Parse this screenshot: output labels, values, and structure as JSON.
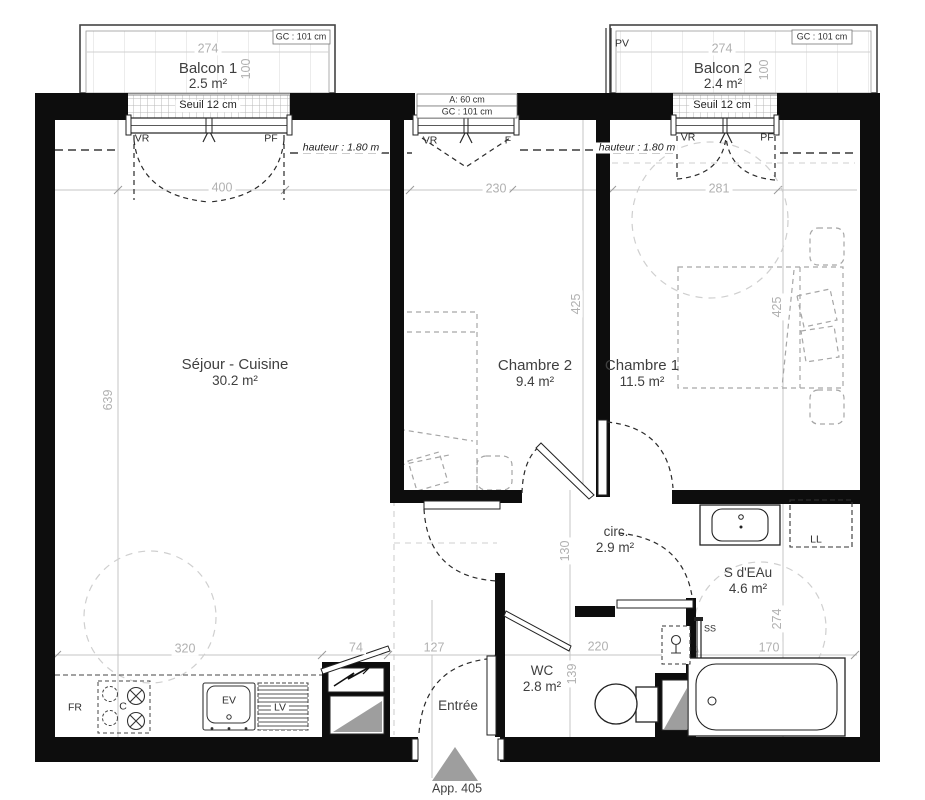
{
  "plan": {
    "apartment": "App. 405",
    "pmr": "PMR",
    "entree": "Entrée"
  },
  "balconies": {
    "b1": {
      "name": "Balcon 1",
      "area": "2.5 m²",
      "width": "274",
      "depth": "100",
      "gc": "GC : 101 cm",
      "seuil": "Seuil 12 cm"
    },
    "b2": {
      "name": "Balcon 2",
      "area": "2.4 m²",
      "width": "274",
      "depth": "100",
      "gc": "GC : 101 cm",
      "seuil": "Seuil 12 cm",
      "pv": "PV"
    }
  },
  "windows": {
    "left": {
      "vr": "VR",
      "pf": "PF",
      "dim": "400",
      "hauteur": "hauteur : 1.80 m"
    },
    "middle": {
      "a": "A: 60 cm",
      "gc": "GC : 101 cm",
      "vr": "VR",
      "f": "F",
      "dim": "230"
    },
    "right": {
      "vr": "VR",
      "pf": "PF",
      "dim": "281",
      "hauteur": "hauteur : 1.80 m"
    }
  },
  "rooms": {
    "sejour": {
      "name": "Séjour - Cuisine",
      "area": "30.2 m²"
    },
    "chambre2": {
      "name": "Chambre 2",
      "area": "9.4 m²"
    },
    "chambre1": {
      "name": "Chambre 1",
      "area": "11.5 m²"
    },
    "circ": {
      "name": "circ.",
      "area": "2.9 m²"
    },
    "sdeau": {
      "name": "S d'EAu",
      "area": "4.6 m²"
    },
    "wc": {
      "name": "WC",
      "area": "2.8 m²"
    }
  },
  "dims": {
    "sejour_h": "639",
    "ch2_h": "425",
    "ch1_h": "425",
    "circ_h": "130",
    "wc_h": "139",
    "bain_h": "274",
    "kitchen_w": "320",
    "closet_w": "74",
    "entree_w": "127",
    "wc_w": "220",
    "bain_w": "170"
  },
  "equipment": {
    "fr": "FR",
    "cook": "C",
    "sink": "EV",
    "dishwasher": "LV",
    "washer": "LL",
    "towel": "SS"
  },
  "colors": {
    "wall": "#0d0d0d",
    "dim": "#b1b1b1",
    "label": "#3f3f3f",
    "triangle": "#9e9e9e"
  }
}
